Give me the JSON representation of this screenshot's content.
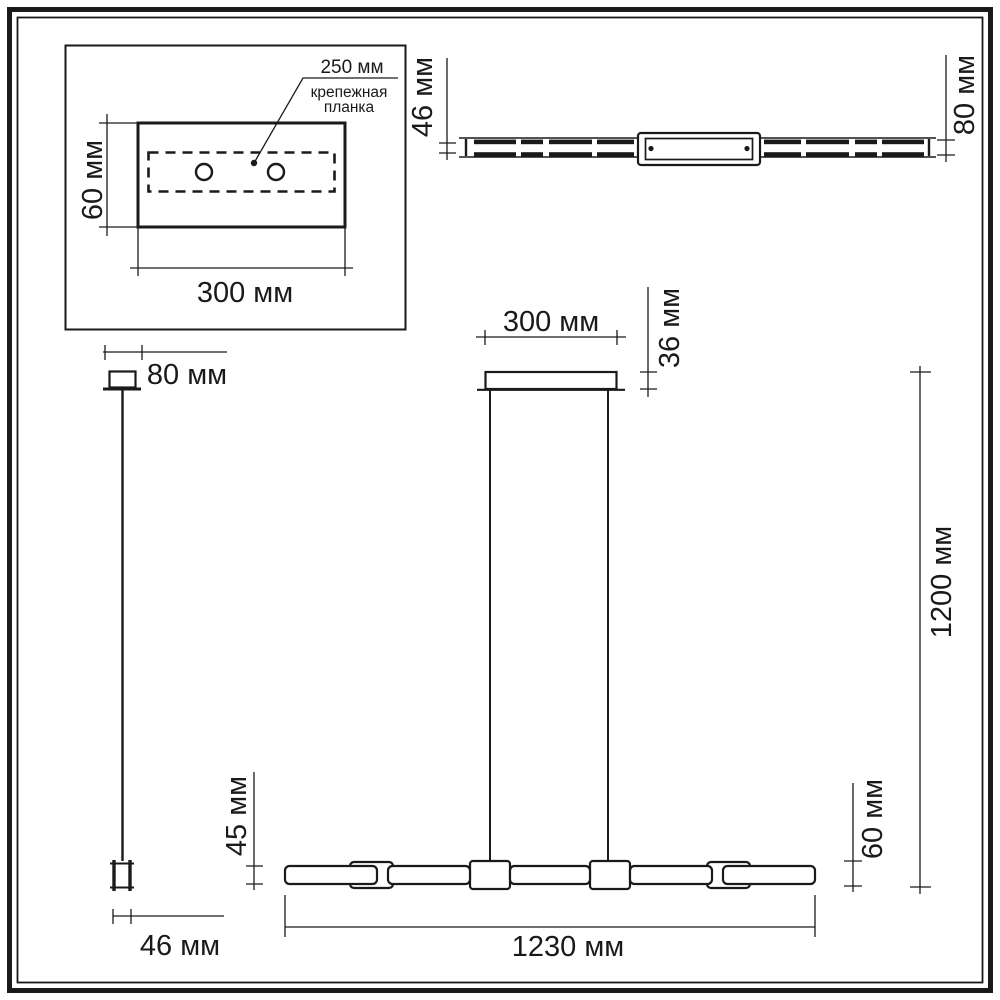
{
  "colors": {
    "ink": "#1a1a1a",
    "paper": "#ffffff"
  },
  "inset_plate_view": {
    "hole_spacing_label": "250 мм",
    "bracket_label_line1": "крепежная",
    "bracket_label_line2": "планка",
    "plate_height": "60 мм",
    "plate_width": "300 мм"
  },
  "top_view": {
    "bar_thickness": "46 мм",
    "bar_width": "80 мм"
  },
  "side_view": {
    "canopy_width": "80 мм",
    "bar_depth": "46 мм"
  },
  "front_view": {
    "canopy_width": "300 мм",
    "canopy_height": "36 мм",
    "suspension_height": "1200 мм",
    "connector_height": "60 мм",
    "tube_height": "45 мм",
    "total_length": "1230 мм"
  }
}
